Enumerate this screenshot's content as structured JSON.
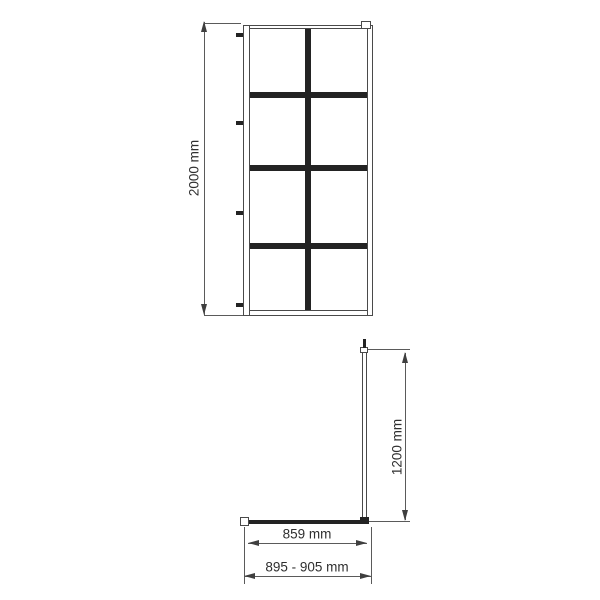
{
  "front_view": {
    "height_label": "2000 mm",
    "grid_rows": 4,
    "grid_columns": 2,
    "wall_fixing_count": 4
  },
  "plan_view": {
    "support_bar_label": "1200 mm",
    "glass_width_label": "859 mm",
    "installation_width_label": "895 - 905 mm"
  },
  "colors": {
    "outline": "#4a4a4a",
    "grid_bar": "#232323",
    "dimension_line": "#5a5a5a",
    "arrow": "#3f3f3f",
    "text": "#2f2f2f",
    "background": "#ffffff"
  }
}
